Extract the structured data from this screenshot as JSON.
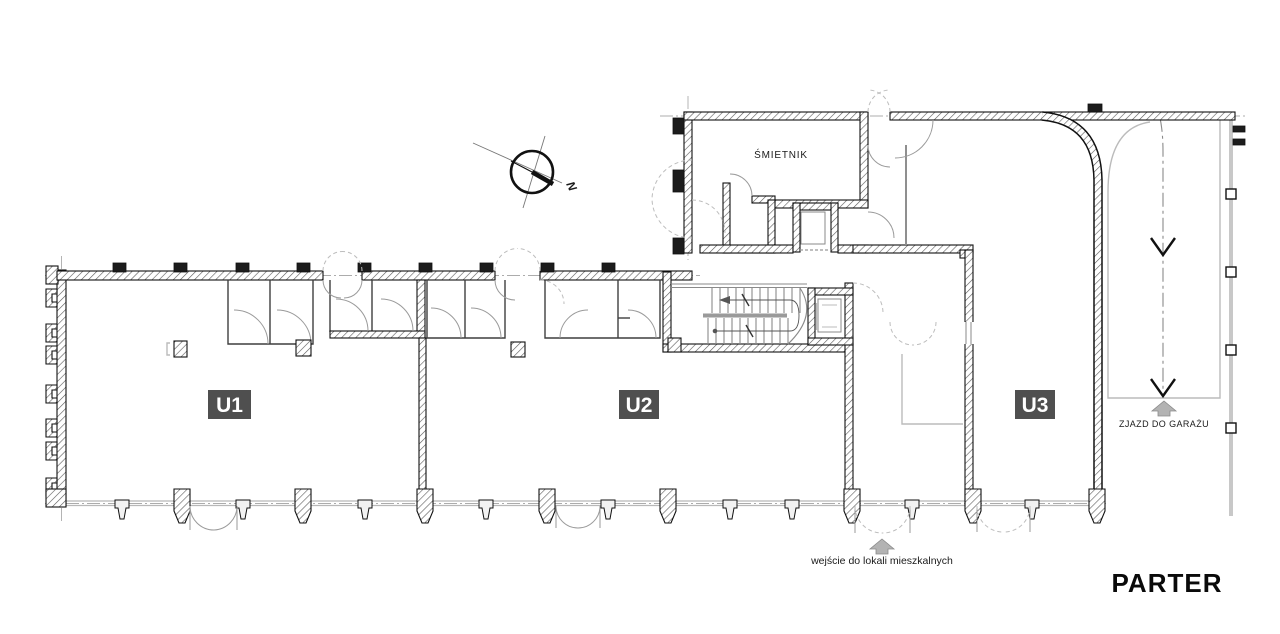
{
  "drawing": {
    "title": "PARTER",
    "units": [
      {
        "label": "U1"
      },
      {
        "label": "U2"
      },
      {
        "label": "U3"
      }
    ],
    "rooms": [
      {
        "label": "ŚMIETNIK"
      }
    ],
    "annotations": {
      "garage_ramp": "ZJAZD DO GARAŻU",
      "residential_entrance": "wejście do lokali mieszkalnych",
      "north": "N"
    },
    "colors": {
      "wall": "#111111",
      "unit_label_bg": "#4f4f4f",
      "unit_label_text": "#ffffff",
      "glazing": "#b8b8b8",
      "arrow_fill": "#b3b3b3",
      "text": "#1a1a1a"
    }
  }
}
